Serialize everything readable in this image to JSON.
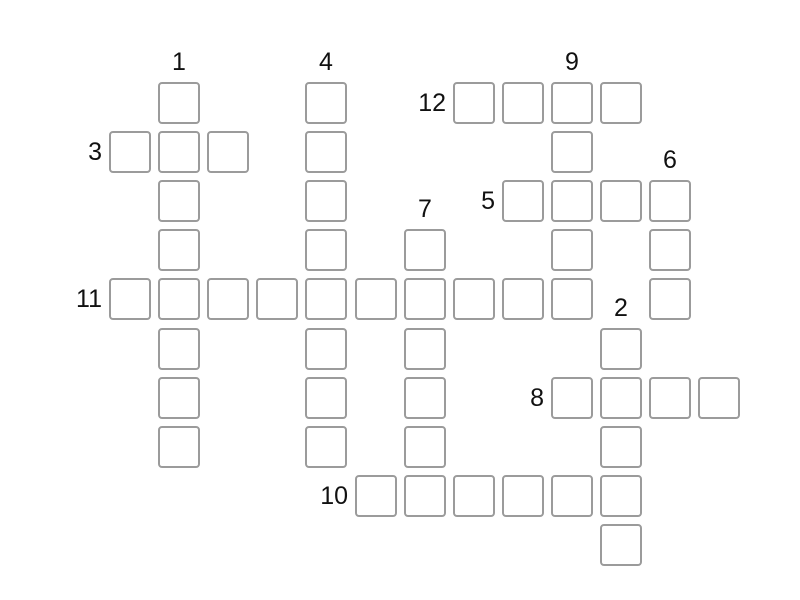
{
  "page": {
    "type": "crossword-puzzle",
    "background_color": "#ffffff"
  },
  "crossword": {
    "colors": {
      "cell_border": "#9b9b9b",
      "cell_fill": "#ffffff",
      "number_text": "#111111"
    },
    "cells_are_empty": true,
    "cell_value_placeholder": "",
    "words": [
      {
        "number": 1,
        "direction": "down",
        "row": 0,
        "col": 1,
        "length": 8
      },
      {
        "number": 2,
        "direction": "down",
        "row": 5,
        "col": 10,
        "length": 5
      },
      {
        "number": 3,
        "direction": "across",
        "row": 1,
        "col": 0,
        "length": 3
      },
      {
        "number": 4,
        "direction": "down",
        "row": 0,
        "col": 4,
        "length": 8
      },
      {
        "number": 5,
        "direction": "across",
        "row": 2,
        "col": 8,
        "length": 4
      },
      {
        "number": 6,
        "direction": "down",
        "row": 2,
        "col": 11,
        "length": 3
      },
      {
        "number": 7,
        "direction": "down",
        "row": 3,
        "col": 6,
        "length": 6
      },
      {
        "number": 8,
        "direction": "across",
        "row": 6,
        "col": 9,
        "length": 4
      },
      {
        "number": 9,
        "direction": "down",
        "row": 0,
        "col": 9,
        "length": 5
      },
      {
        "number": 10,
        "direction": "across",
        "row": 8,
        "col": 5,
        "length": 6
      },
      {
        "number": 11,
        "direction": "across",
        "row": 4,
        "col": 0,
        "length": 10
      },
      {
        "number": 12,
        "direction": "across",
        "row": 0,
        "col": 7,
        "length": 4
      }
    ]
  }
}
